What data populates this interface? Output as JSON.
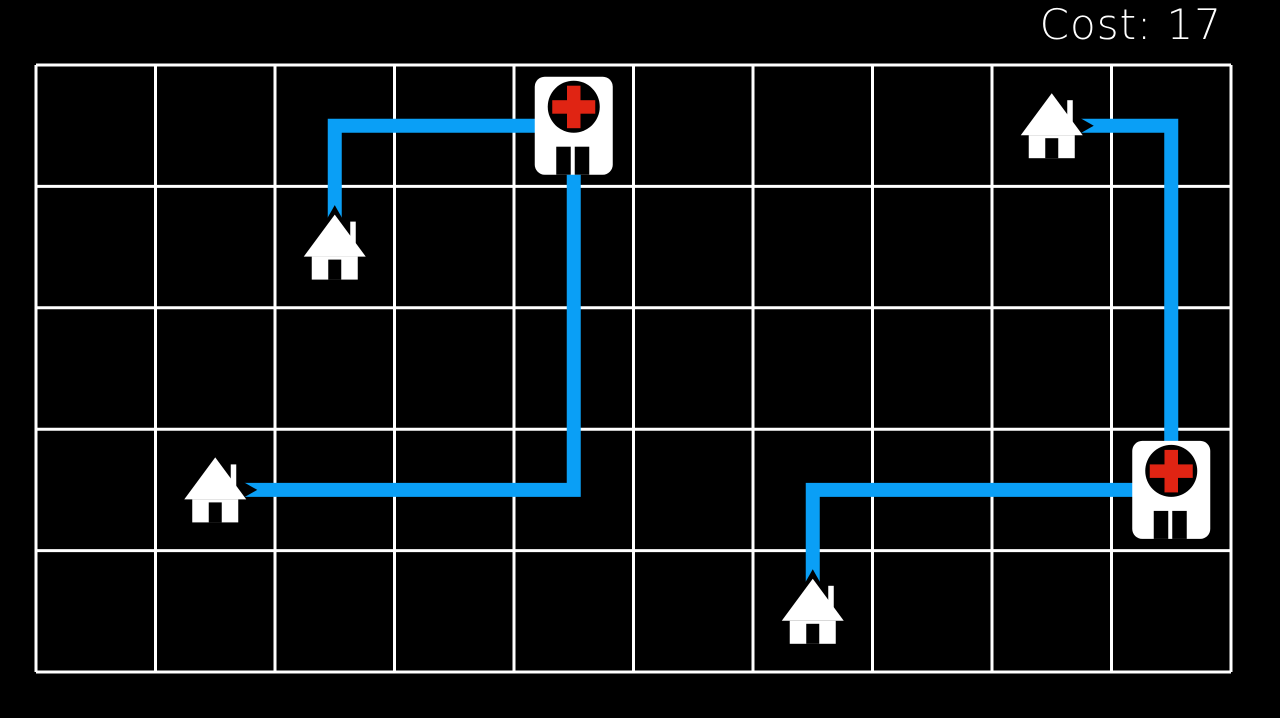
{
  "hud": {
    "cost_label": "Cost",
    "cost_value": 17,
    "cost_display": "Cost: 17"
  },
  "colors": {
    "background": "#000000",
    "grid_line": "#ffffff",
    "path": "#0a9ff6",
    "building": "#ffffff",
    "cross": "#e02413",
    "door": "#000000",
    "text": "#ffffff"
  },
  "board": {
    "columns": 10,
    "rows": 5
  },
  "icons": {
    "house": "house-icon",
    "hospital": "hospital-cross-icon"
  },
  "houses": [
    {
      "id": "house-1",
      "col": 2,
      "row": 1
    },
    {
      "id": "house-2",
      "col": 1,
      "row": 3
    },
    {
      "id": "house-3",
      "col": 6,
      "row": 4
    },
    {
      "id": "house-4",
      "col": 8,
      "row": 0
    }
  ],
  "hospitals": [
    {
      "id": "hospital-1",
      "col": 4,
      "row": 0
    },
    {
      "id": "hospital-2",
      "col": 9,
      "row": 3
    }
  ],
  "routes": [
    {
      "from": "house-1",
      "to": "hospital-1",
      "cells": [
        [
          2,
          1
        ],
        [
          2,
          0
        ],
        [
          4,
          0
        ]
      ]
    },
    {
      "from": "house-2",
      "to": "hospital-1",
      "cells": [
        [
          1,
          3
        ],
        [
          4,
          3
        ],
        [
          4,
          0
        ]
      ]
    },
    {
      "from": "house-3",
      "to": "hospital-2",
      "cells": [
        [
          6,
          4
        ],
        [
          6,
          3
        ],
        [
          9,
          3
        ]
      ]
    },
    {
      "from": "house-4",
      "to": "hospital-2",
      "cells": [
        [
          8,
          0
        ],
        [
          9,
          0
        ],
        [
          9,
          3
        ]
      ]
    }
  ]
}
